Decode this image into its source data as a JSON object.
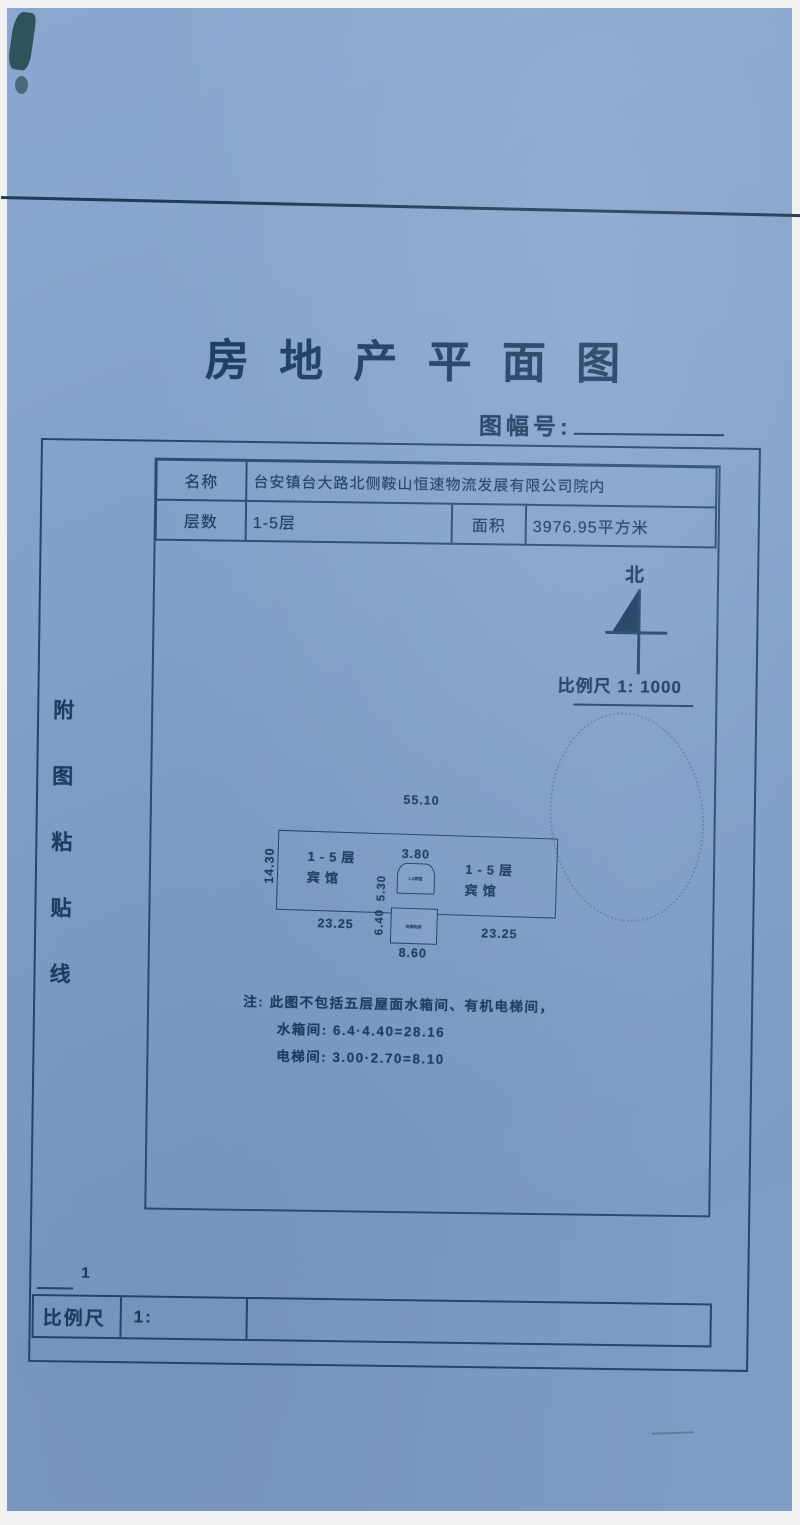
{
  "colors": {
    "paper_blue": "#84a2cb",
    "ink": "#1d3c62",
    "line": "#24466d",
    "fold_line": "#17304a"
  },
  "doc": {
    "title": "房 地 产 平 面 图",
    "sheet_label": "图幅号:",
    "paste_line": [
      "附",
      "图",
      "粘",
      "贴",
      "线"
    ],
    "table": {
      "name_label": "名称",
      "name_value": "台安镇台大路北侧鞍山恒速物流发展有限公司院内",
      "floors_label": "层数",
      "floors_value": "1-5层",
      "area_label": "面积",
      "area_value": "3976.95平方米"
    },
    "north_label": "北",
    "scale_note": "比例尺 1: 1000",
    "plan": {
      "dim_total_width": "55.10",
      "dim_total_height": "14.30",
      "left_wing_floors": "1-5层",
      "left_wing_use": "宾馆",
      "right_wing_floors": "1-5层",
      "right_wing_use": "宾馆",
      "dim_mid_width": "3.80",
      "dim_mid_height_upper": "5.30",
      "dim_mid_height_lower": "6.40",
      "dim_left_wing": "23.25",
      "dim_right_wing": "23.25",
      "dim_mid_bottom": "8.60",
      "mid_upper_label": "1-5宾馆",
      "mid_lower_label": "电梯机房"
    },
    "notes": {
      "line1": "注: 此图不包括五层屋面水箱间、有机电梯间，",
      "line2": "水箱间: 6.4·4.40=28.16",
      "line3": "电梯间: 3.00·2.70=8.10"
    },
    "bottom_scale": {
      "label": "比例尺",
      "value": "1:",
      "numerator": "1"
    }
  }
}
